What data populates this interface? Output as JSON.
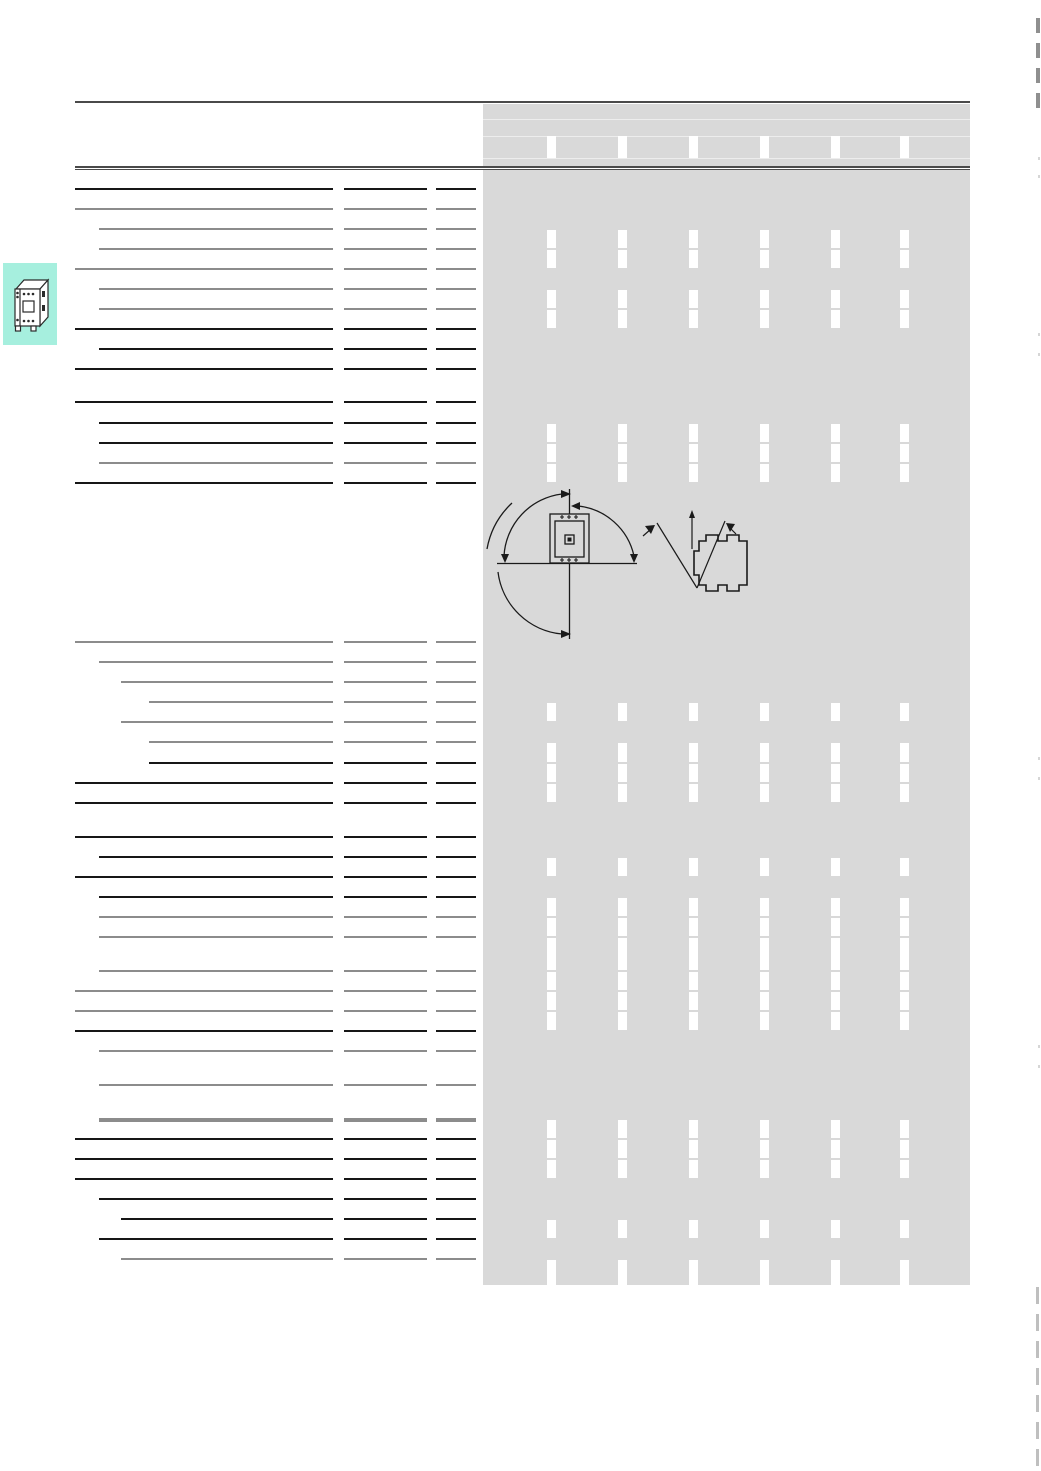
{
  "page": {
    "width": 1041,
    "height": 1471,
    "background": "#ffffff"
  },
  "colors": {
    "table_fill": "#d9d9d9",
    "line_dark": "#161616",
    "line_gray": "#8c8c8c",
    "rule": "#4a4a4a",
    "header_subline": "#ededed",
    "gap_white": "#ffffff",
    "tab_teal": "#a6efde",
    "mark_dark": "#8f8f8f",
    "mark_light": "#bfbfbf",
    "mark_faint": "#d6d6d6",
    "drawing_stroke": "#1a1a1a"
  },
  "layout": {
    "rule_top": {
      "x": 75,
      "y": 100.5,
      "w": 895,
      "h": 2.5
    },
    "header": {
      "x": 483,
      "y": 103.5,
      "w": 487,
      "h": 62,
      "sublines_y": [
        119,
        136,
        158
      ],
      "gap_band_top": 136,
      "gap_band_bottom": 158
    },
    "rule_double": {
      "x": 75,
      "y": 165.5,
      "w": 895,
      "dark1": 2,
      "gap": 1,
      "dark2": 1.5
    },
    "grid": {
      "left": 483,
      "right": 970,
      "bottom": 1285,
      "label_end": 333,
      "mid_seg": [
        344,
        427
      ],
      "right_seg": [
        436,
        476
      ],
      "indents": [
        75,
        99,
        121,
        149
      ],
      "gap_lefts": [
        547,
        618,
        689,
        760,
        831,
        900
      ],
      "gap_width": 9,
      "sep_h": 2,
      "sep_h_thick": 3.5,
      "columns": 7
    }
  },
  "rows": [
    {
      "y0": 170,
      "y1": 188,
      "fill": "plain",
      "sep": "dark",
      "indent": 0,
      "cut": false
    },
    {
      "y0": 188,
      "y1": 208,
      "fill": "plain",
      "sep": "gray",
      "indent": 0,
      "cut": false
    },
    {
      "y0": 208,
      "y1": 228,
      "fill": "plain",
      "sep": "gray",
      "indent": 1,
      "cut": false
    },
    {
      "y0": 228,
      "y1": 248,
      "fill": "gaps",
      "sep": "gray",
      "indent": 1,
      "cut": true
    },
    {
      "y0": 248,
      "y1": 268,
      "fill": "gaps",
      "sep": "gray",
      "indent": 0,
      "cut": false
    },
    {
      "y0": 268,
      "y1": 288,
      "fill": "plain",
      "sep": "gray",
      "indent": 1,
      "cut": false
    },
    {
      "y0": 288,
      "y1": 308,
      "fill": "gaps",
      "sep": "gray",
      "indent": 1,
      "cut": true
    },
    {
      "y0": 308,
      "y1": 328,
      "fill": "gaps",
      "sep": "dark",
      "indent": 0,
      "cut": false
    },
    {
      "y0": 328,
      "y1": 348,
      "fill": "plain",
      "sep": "dark",
      "indent": 1,
      "cut": false
    },
    {
      "y0": 348,
      "y1": 368,
      "fill": "plain",
      "sep": "dark",
      "indent": 0,
      "cut": false
    },
    {
      "y0": 368,
      "y1": 401,
      "fill": "plain",
      "sep": "dark",
      "indent": 0,
      "cut": false
    },
    {
      "y0": 401,
      "y1": 422,
      "fill": "plain",
      "sep": "dark",
      "indent": 1,
      "cut": false
    },
    {
      "y0": 422,
      "y1": 442,
      "fill": "gaps",
      "sep": "dark",
      "indent": 1,
      "cut": true
    },
    {
      "y0": 442,
      "y1": 462,
      "fill": "gaps",
      "sep": "gray",
      "indent": 1,
      "cut": true
    },
    {
      "y0": 462,
      "y1": 482,
      "fill": "gaps",
      "sep": "dark",
      "indent": 0,
      "cut": false
    },
    {
      "y0": 482,
      "y1": 641,
      "fill": "drawing",
      "sep": "gray",
      "indent": 0,
      "cut": false
    },
    {
      "y0": 641,
      "y1": 661,
      "fill": "plain",
      "sep": "gray",
      "indent": 1,
      "cut": false
    },
    {
      "y0": 661,
      "y1": 681,
      "fill": "plain",
      "sep": "gray",
      "indent": 2,
      "cut": false
    },
    {
      "y0": 681,
      "y1": 701,
      "fill": "plain",
      "sep": "gray",
      "indent": 3,
      "cut": false
    },
    {
      "y0": 701,
      "y1": 721,
      "fill": "gaps",
      "sep": "gray",
      "indent": 2,
      "cut": false
    },
    {
      "y0": 721,
      "y1": 741,
      "fill": "plain",
      "sep": "gray",
      "indent": 3,
      "cut": false
    },
    {
      "y0": 741,
      "y1": 762,
      "fill": "gaps",
      "sep": "dark",
      "indent": 3,
      "cut": true
    },
    {
      "y0": 762,
      "y1": 782,
      "fill": "gaps",
      "sep": "dark",
      "indent": 0,
      "cut": true
    },
    {
      "y0": 782,
      "y1": 802,
      "fill": "gaps",
      "sep": "dark",
      "indent": 0,
      "cut": false
    },
    {
      "y0": 802,
      "y1": 836,
      "fill": "plain",
      "sep": "dark",
      "indent": 0,
      "cut": false
    },
    {
      "y0": 836,
      "y1": 856,
      "fill": "plain",
      "sep": "dark",
      "indent": 1,
      "cut": false
    },
    {
      "y0": 856,
      "y1": 876,
      "fill": "gaps",
      "sep": "dark",
      "indent": 0,
      "cut": false
    },
    {
      "y0": 876,
      "y1": 896,
      "fill": "plain",
      "sep": "dark",
      "indent": 1,
      "cut": false
    },
    {
      "y0": 896,
      "y1": 916,
      "fill": "gaps",
      "sep": "gray",
      "indent": 1,
      "cut": true
    },
    {
      "y0": 916,
      "y1": 936,
      "fill": "gaps",
      "sep": "gray",
      "indent": 1,
      "cut": true
    },
    {
      "y0": 936,
      "y1": 970,
      "fill": "gaps",
      "sep": "gray",
      "indent": 1,
      "cut": true
    },
    {
      "y0": 970,
      "y1": 990,
      "fill": "gaps",
      "sep": "gray",
      "indent": 0,
      "cut": true
    },
    {
      "y0": 990,
      "y1": 1010,
      "fill": "gaps",
      "sep": "gray",
      "indent": 0,
      "cut": true
    },
    {
      "y0": 1010,
      "y1": 1030,
      "fill": "gaps",
      "sep": "dark",
      "indent": 0,
      "cut": false
    },
    {
      "y0": 1030,
      "y1": 1050,
      "fill": "plain",
      "sep": "gray",
      "indent": 1,
      "cut": false
    },
    {
      "y0": 1050,
      "y1": 1084,
      "fill": "plain",
      "sep": "gray",
      "indent": 1,
      "cut": false
    },
    {
      "y0": 1084,
      "y1": 1118,
      "fill": "plain",
      "sep": "gray_thick",
      "indent": 1,
      "cut": false
    },
    {
      "y0": 1118,
      "y1": 1138,
      "fill": "gaps",
      "sep": "dark",
      "indent": 0,
      "cut": true
    },
    {
      "y0": 1138,
      "y1": 1158,
      "fill": "gaps",
      "sep": "dark",
      "indent": 0,
      "cut": true
    },
    {
      "y0": 1158,
      "y1": 1178,
      "fill": "gaps",
      "sep": "dark",
      "indent": 0,
      "cut": false
    },
    {
      "y0": 1178,
      "y1": 1198,
      "fill": "plain",
      "sep": "dark",
      "indent": 1,
      "cut": false
    },
    {
      "y0": 1198,
      "y1": 1218,
      "fill": "plain",
      "sep": "dark",
      "indent": 2,
      "cut": false
    },
    {
      "y0": 1218,
      "y1": 1238,
      "fill": "gaps",
      "sep": "dark",
      "indent": 1,
      "cut": false
    },
    {
      "y0": 1238,
      "y1": 1258,
      "fill": "plain",
      "sep": "gray",
      "indent": 2,
      "cut": false
    },
    {
      "y0": 1258,
      "y1": 1285,
      "fill": "gaps",
      "sep": "none",
      "indent": 0,
      "cut": false
    }
  ],
  "tab": {
    "x": 3,
    "y": 263,
    "w": 54,
    "h": 82,
    "icon": "contactor-product-icon"
  },
  "edge_marks": {
    "top": [
      {
        "x": 1036,
        "y": 18,
        "w": 4,
        "h": 15
      },
      {
        "x": 1036,
        "y": 43,
        "w": 4,
        "h": 15
      },
      {
        "x": 1036,
        "y": 68,
        "w": 4,
        "h": 15
      },
      {
        "x": 1036,
        "y": 93,
        "w": 4,
        "h": 15
      }
    ],
    "bottom": [
      {
        "x": 1036,
        "y": 1287,
        "w": 3,
        "h": 17
      },
      {
        "x": 1036,
        "y": 1314,
        "w": 3,
        "h": 17
      },
      {
        "x": 1036,
        "y": 1341,
        "w": 3,
        "h": 17
      },
      {
        "x": 1036,
        "y": 1368,
        "w": 3,
        "h": 17
      },
      {
        "x": 1036,
        "y": 1395,
        "w": 3,
        "h": 17
      },
      {
        "x": 1036,
        "y": 1422,
        "w": 3,
        "h": 17
      },
      {
        "x": 1036,
        "y": 1449,
        "w": 3,
        "h": 17
      }
    ],
    "faint": [
      {
        "x": 1038,
        "y": 157,
        "w": 2,
        "h": 3
      },
      {
        "x": 1038,
        "y": 175,
        "w": 2,
        "h": 3
      },
      {
        "x": 1038,
        "y": 333,
        "w": 2,
        "h": 3
      },
      {
        "x": 1038,
        "y": 353,
        "w": 2,
        "h": 3
      },
      {
        "x": 1038,
        "y": 757,
        "w": 2,
        "h": 3
      },
      {
        "x": 1038,
        "y": 777,
        "w": 2,
        "h": 3
      },
      {
        "x": 1038,
        "y": 1045,
        "w": 2,
        "h": 3
      },
      {
        "x": 1038,
        "y": 1065,
        "w": 2,
        "h": 3
      }
    ]
  }
}
